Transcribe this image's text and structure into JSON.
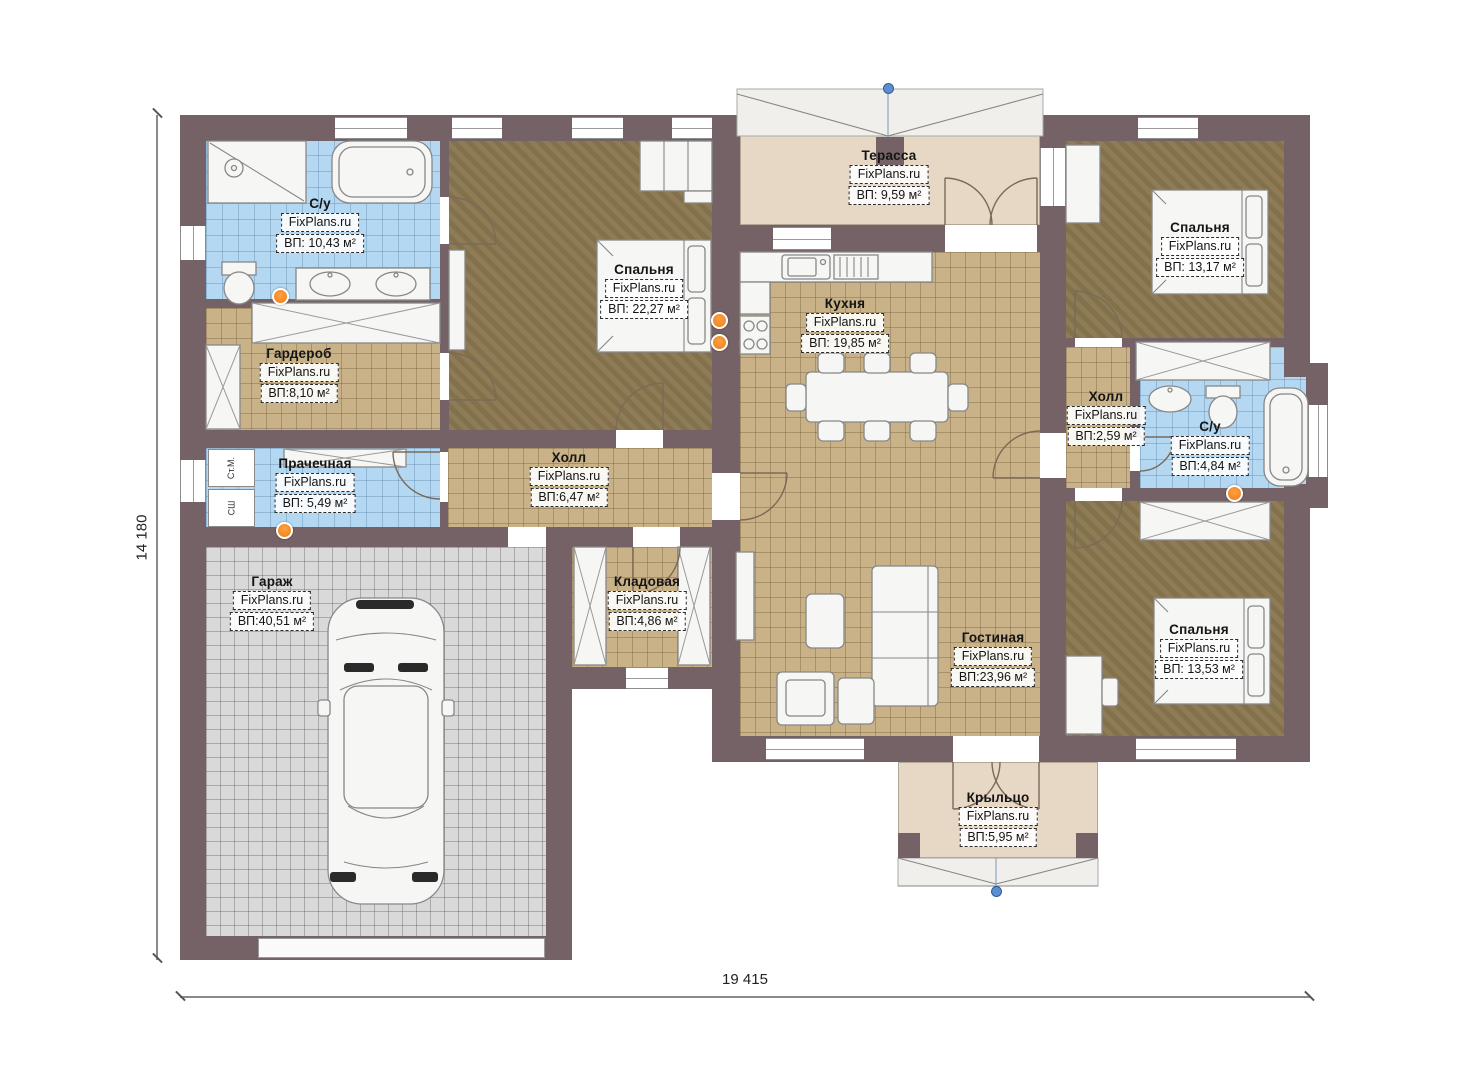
{
  "plan": {
    "brand": "FixPlans.ru",
    "rooms": [
      {
        "id": "bathroom-1",
        "name": "С/у",
        "brand": "FixPlans.ru",
        "area": "ВП: 10,43 м²"
      },
      {
        "id": "bedroom-master",
        "name": "Спальня",
        "brand": "FixPlans.ru",
        "area": "ВП: 22,27 м²"
      },
      {
        "id": "terrace",
        "name": "Терасса",
        "brand": "FixPlans.ru",
        "area": "ВП: 9,59 м²"
      },
      {
        "id": "kitchen",
        "name": "Кухня",
        "brand": "FixPlans.ru",
        "area": "ВП: 19,85 м²"
      },
      {
        "id": "bedroom-2",
        "name": "Спальня",
        "brand": "FixPlans.ru",
        "area": "ВП: 13,17 м²"
      },
      {
        "id": "wardrobe-room",
        "name": "Гардероб",
        "brand": "FixPlans.ru",
        "area": "ВП:8,10 м²"
      },
      {
        "id": "laundry",
        "name": "Прачечная",
        "brand": "FixPlans.ru",
        "area": "ВП: 5,49 м²"
      },
      {
        "id": "hall-main",
        "name": "Холл",
        "brand": "FixPlans.ru",
        "area": "ВП:6,47 м²"
      },
      {
        "id": "garage",
        "name": "Гараж",
        "brand": "FixPlans.ru",
        "area": "ВП:40,51 м²"
      },
      {
        "id": "storage",
        "name": "Кладовая",
        "brand": "FixPlans.ru",
        "area": "ВП:4,86 м²"
      },
      {
        "id": "living-room",
        "name": "Гостиная",
        "brand": "FixPlans.ru",
        "area": "ВП:23,96 м²"
      },
      {
        "id": "hall-right",
        "name": "Холл",
        "brand": "FixPlans.ru",
        "area": "ВП:2,59 м²"
      },
      {
        "id": "bathroom-2",
        "name": "С/у",
        "brand": "FixPlans.ru",
        "area": "ВП:4,84 м²"
      },
      {
        "id": "bedroom-3",
        "name": "Спальня",
        "brand": "FixPlans.ru",
        "area": "ВП: 13,53 м²"
      },
      {
        "id": "porch",
        "name": "Крыльцо",
        "brand": "FixPlans.ru",
        "area": "ВП:5,95 м²"
      }
    ],
    "appliances": {
      "washer": "Ст.М.",
      "dryer": "СШ"
    },
    "dimensions": {
      "height": "14 180",
      "width": "19 415"
    },
    "colors": {
      "wall": "#756266",
      "tile_blue": "#b4d8f2",
      "tile_tan": "#c9b287",
      "floor_brown": "#8a774f",
      "floor_beige": "#e6d8c4",
      "garage_gray": "#d9d9d9",
      "radiator_orange": "#ef7a12",
      "marker_blue": "#5b8fd0"
    }
  }
}
